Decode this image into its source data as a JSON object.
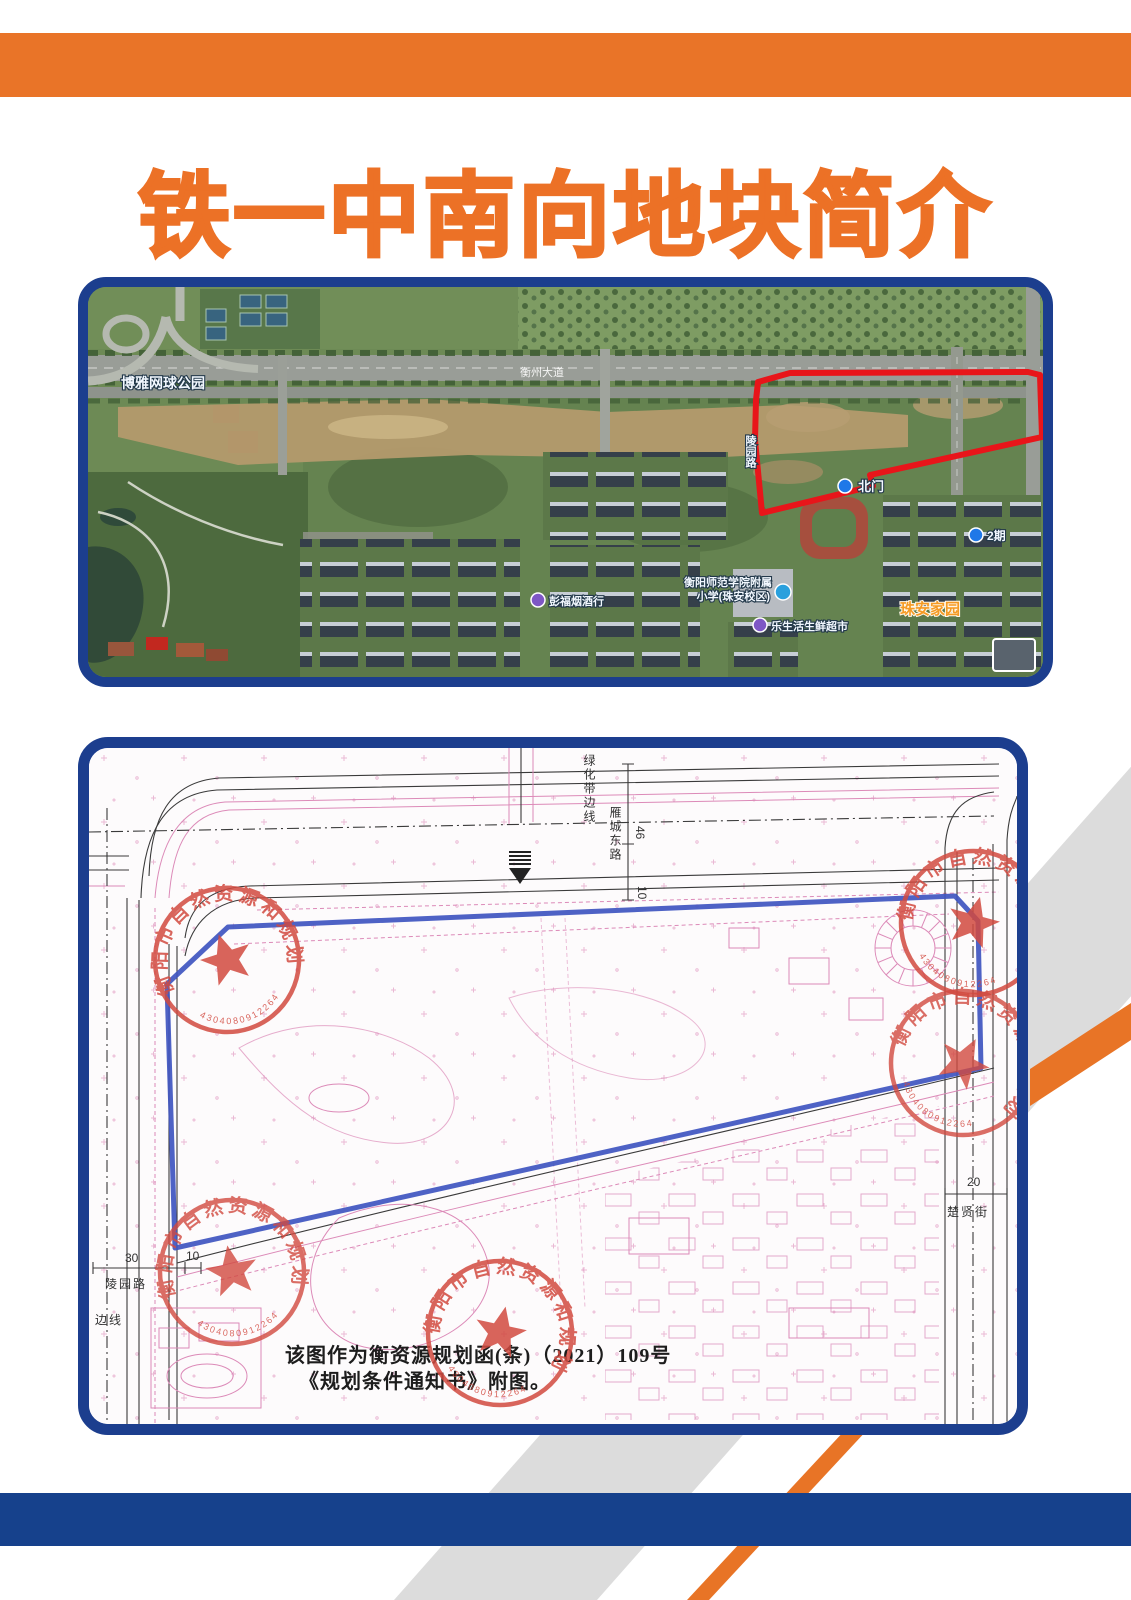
{
  "header": {
    "title": "铁一中南向地块简介"
  },
  "colors": {
    "accent_orange": "#e97428",
    "title_orange": "#ec7126",
    "frame_blue": "#1c3e8e",
    "band_blue": "#16418c",
    "parcel_red": "#e8151a",
    "plan_boundary_blue": "#3f55c0",
    "stamp_red": "#d24a40",
    "cadastral_pink": "#dc8ab8",
    "stripe_gray": "#dcdcdc"
  },
  "satellite_map": {
    "labels": {
      "park": "博雅网球公园",
      "road_main": "衡州大道",
      "road_side": "陵园路",
      "north_gate": "北门",
      "phase2": "2期",
      "shop": "彭福烟酒行",
      "school_line1": "衡阳师范学院附属",
      "school_line2": "小学(珠安校区)",
      "supermarket": "乐生活生鲜超市",
      "estate": "珠安家园"
    }
  },
  "planning_map": {
    "stamp": {
      "agency": "衡阳市自然资源和规划局",
      "serial": "4304080912264"
    },
    "labels": {
      "greenbelt_line": "绿化带边线",
      "road_east": "雁城东路",
      "dim_46": "46",
      "dim_10_top": "10",
      "dim_30": "30",
      "dim_10_left": "10",
      "dim_20": "20",
      "street_chuxian": "楚贤街",
      "road_lingyuan": "陵园路",
      "boundary": "边线",
      "caption_line1": "该图作为衡资源规划函(条)（2021）109号",
      "caption_line2": "《规划条件通知书》附图。"
    }
  }
}
